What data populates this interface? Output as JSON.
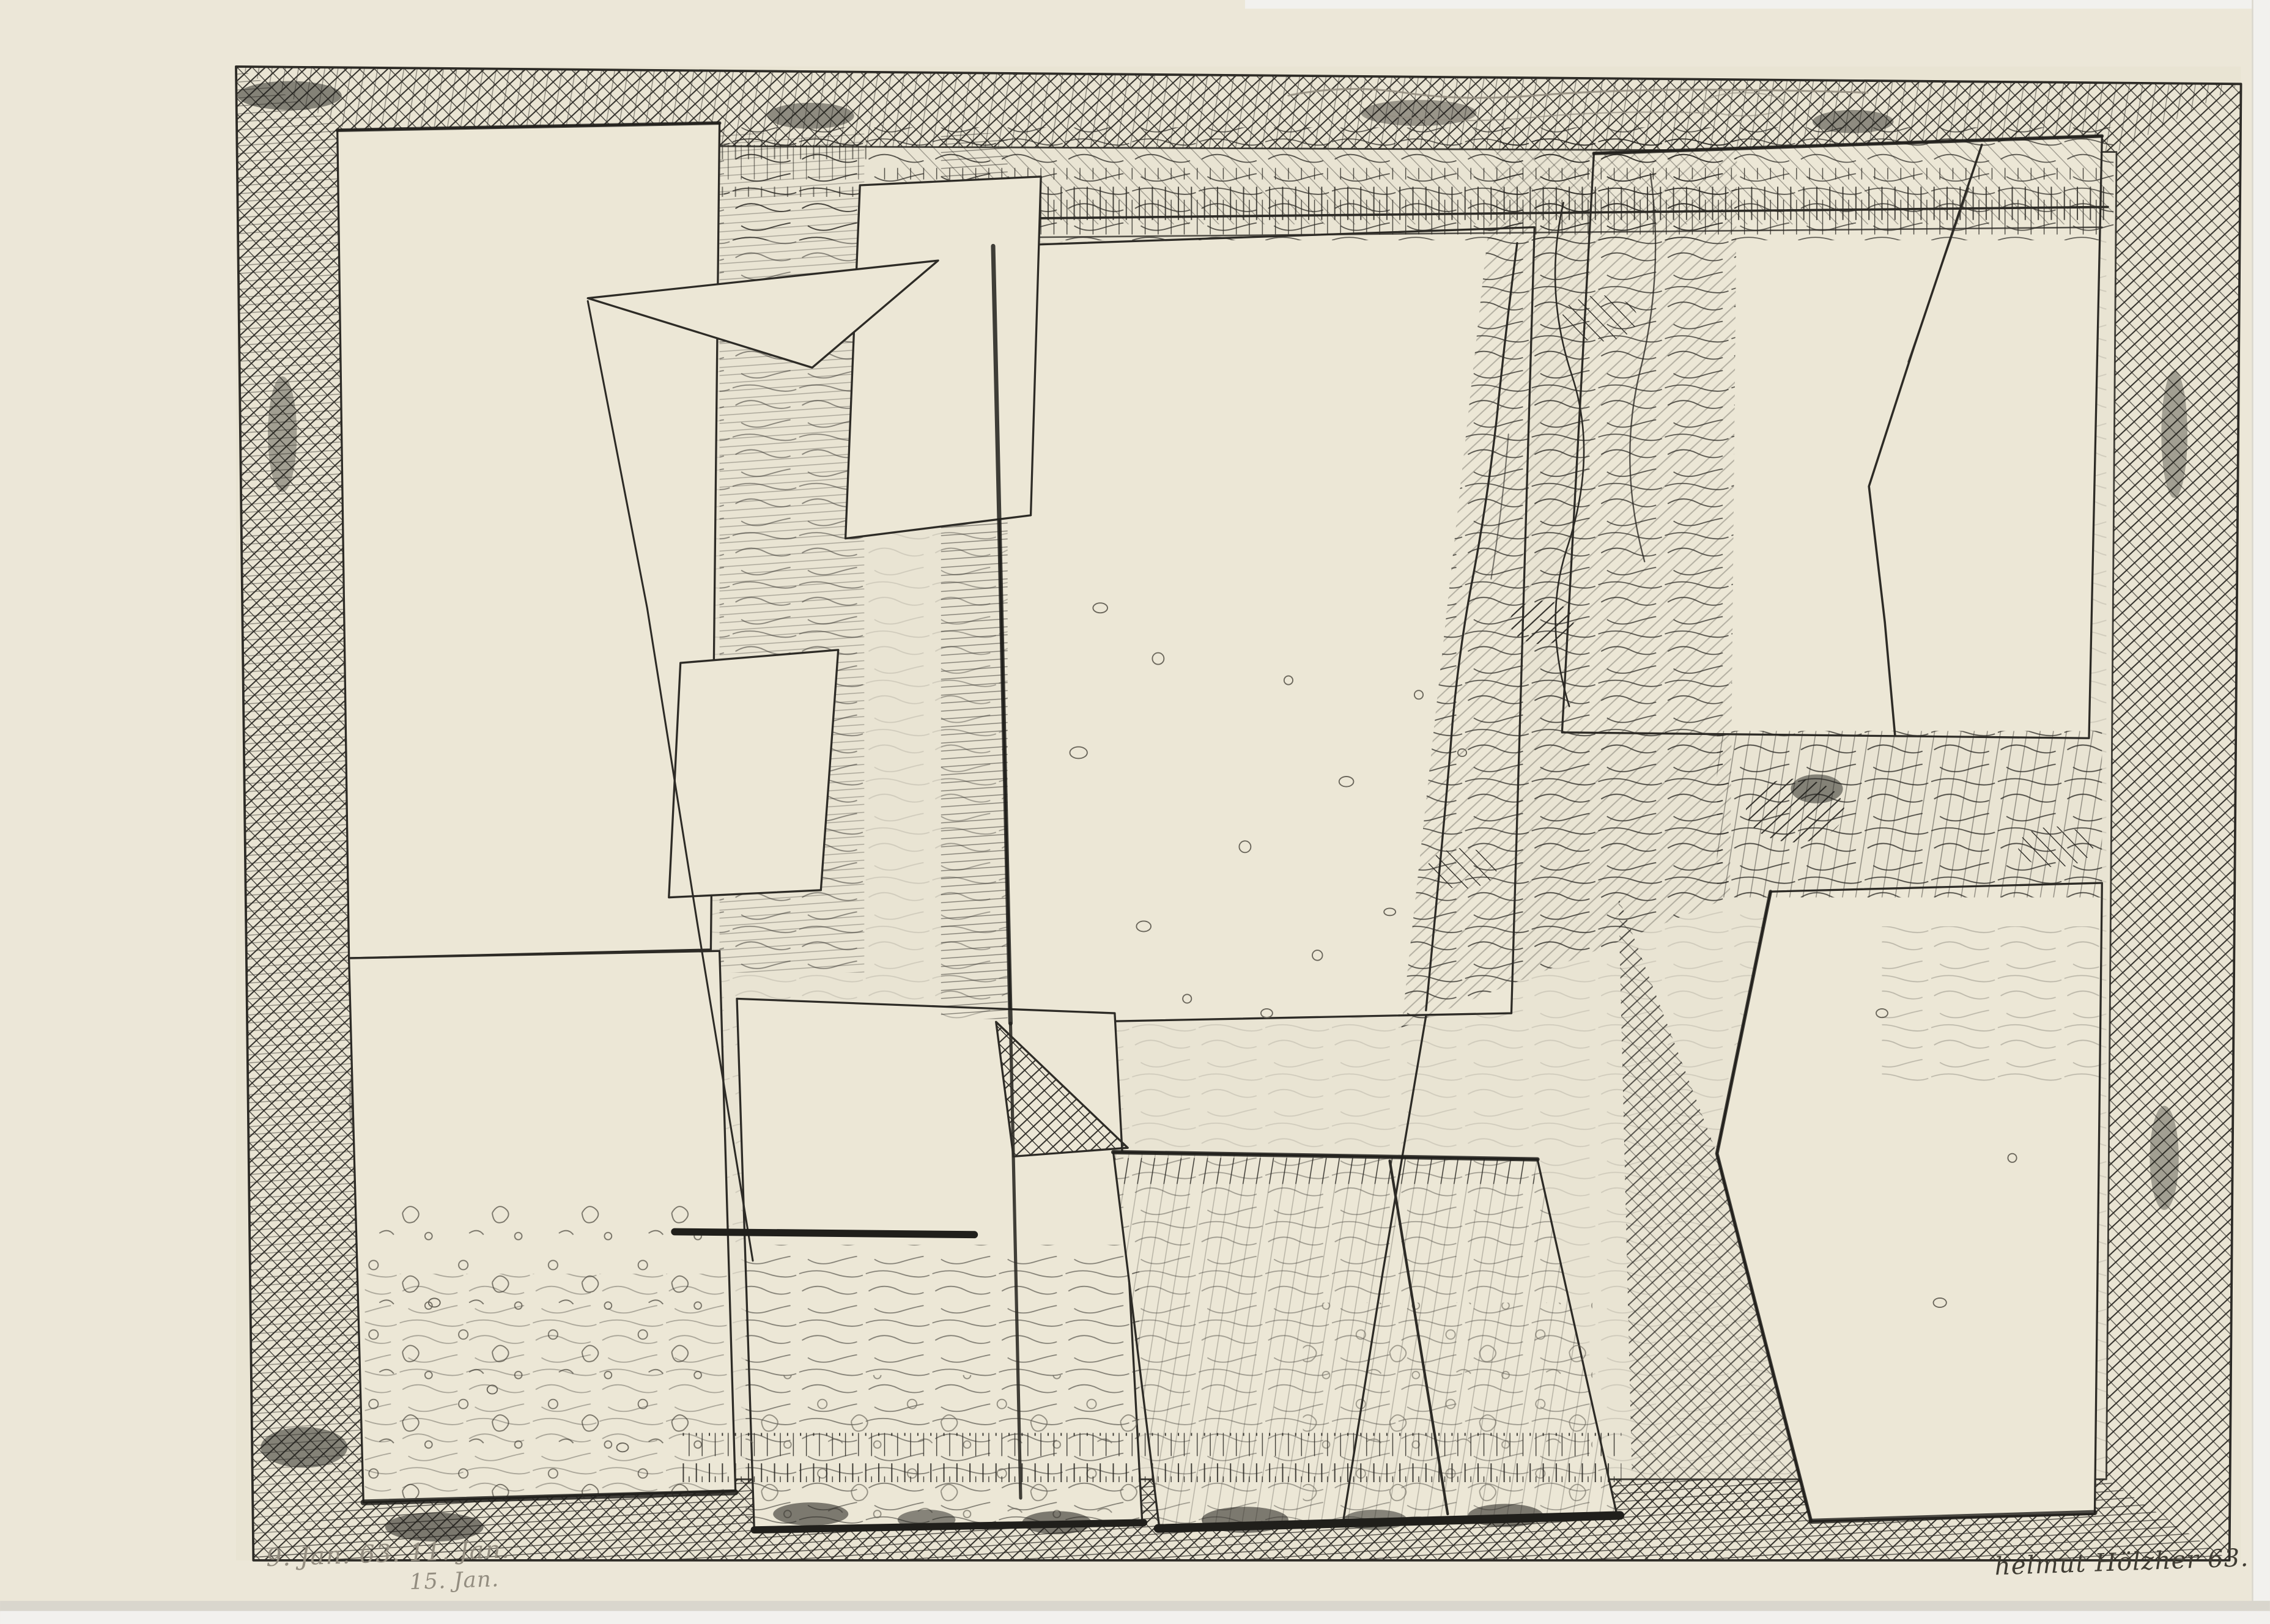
{
  "artwork": {
    "type": "abstract pen-and-ink drawing on cream paper, cross-hatched collage of angular panels inside a hatched border frame",
    "inscription_line1": "9. Jan. 63.  11. Jan.",
    "inscription_line2": "15. Jan.",
    "signature": "helmut Hölzher 63.",
    "colors": {
      "paper": "#e9e4d3",
      "paper_margin": "#ece7d8",
      "panel": "#ece7d6",
      "ink": "#2d2b26",
      "ink_light": "#6a665b",
      "pencil": "#938d80",
      "signature_ink": "#3f3c33",
      "edge_dark": "#201f1b",
      "strip_gray": "#d9d6cd",
      "strip_white": "#f2f1ee"
    }
  }
}
